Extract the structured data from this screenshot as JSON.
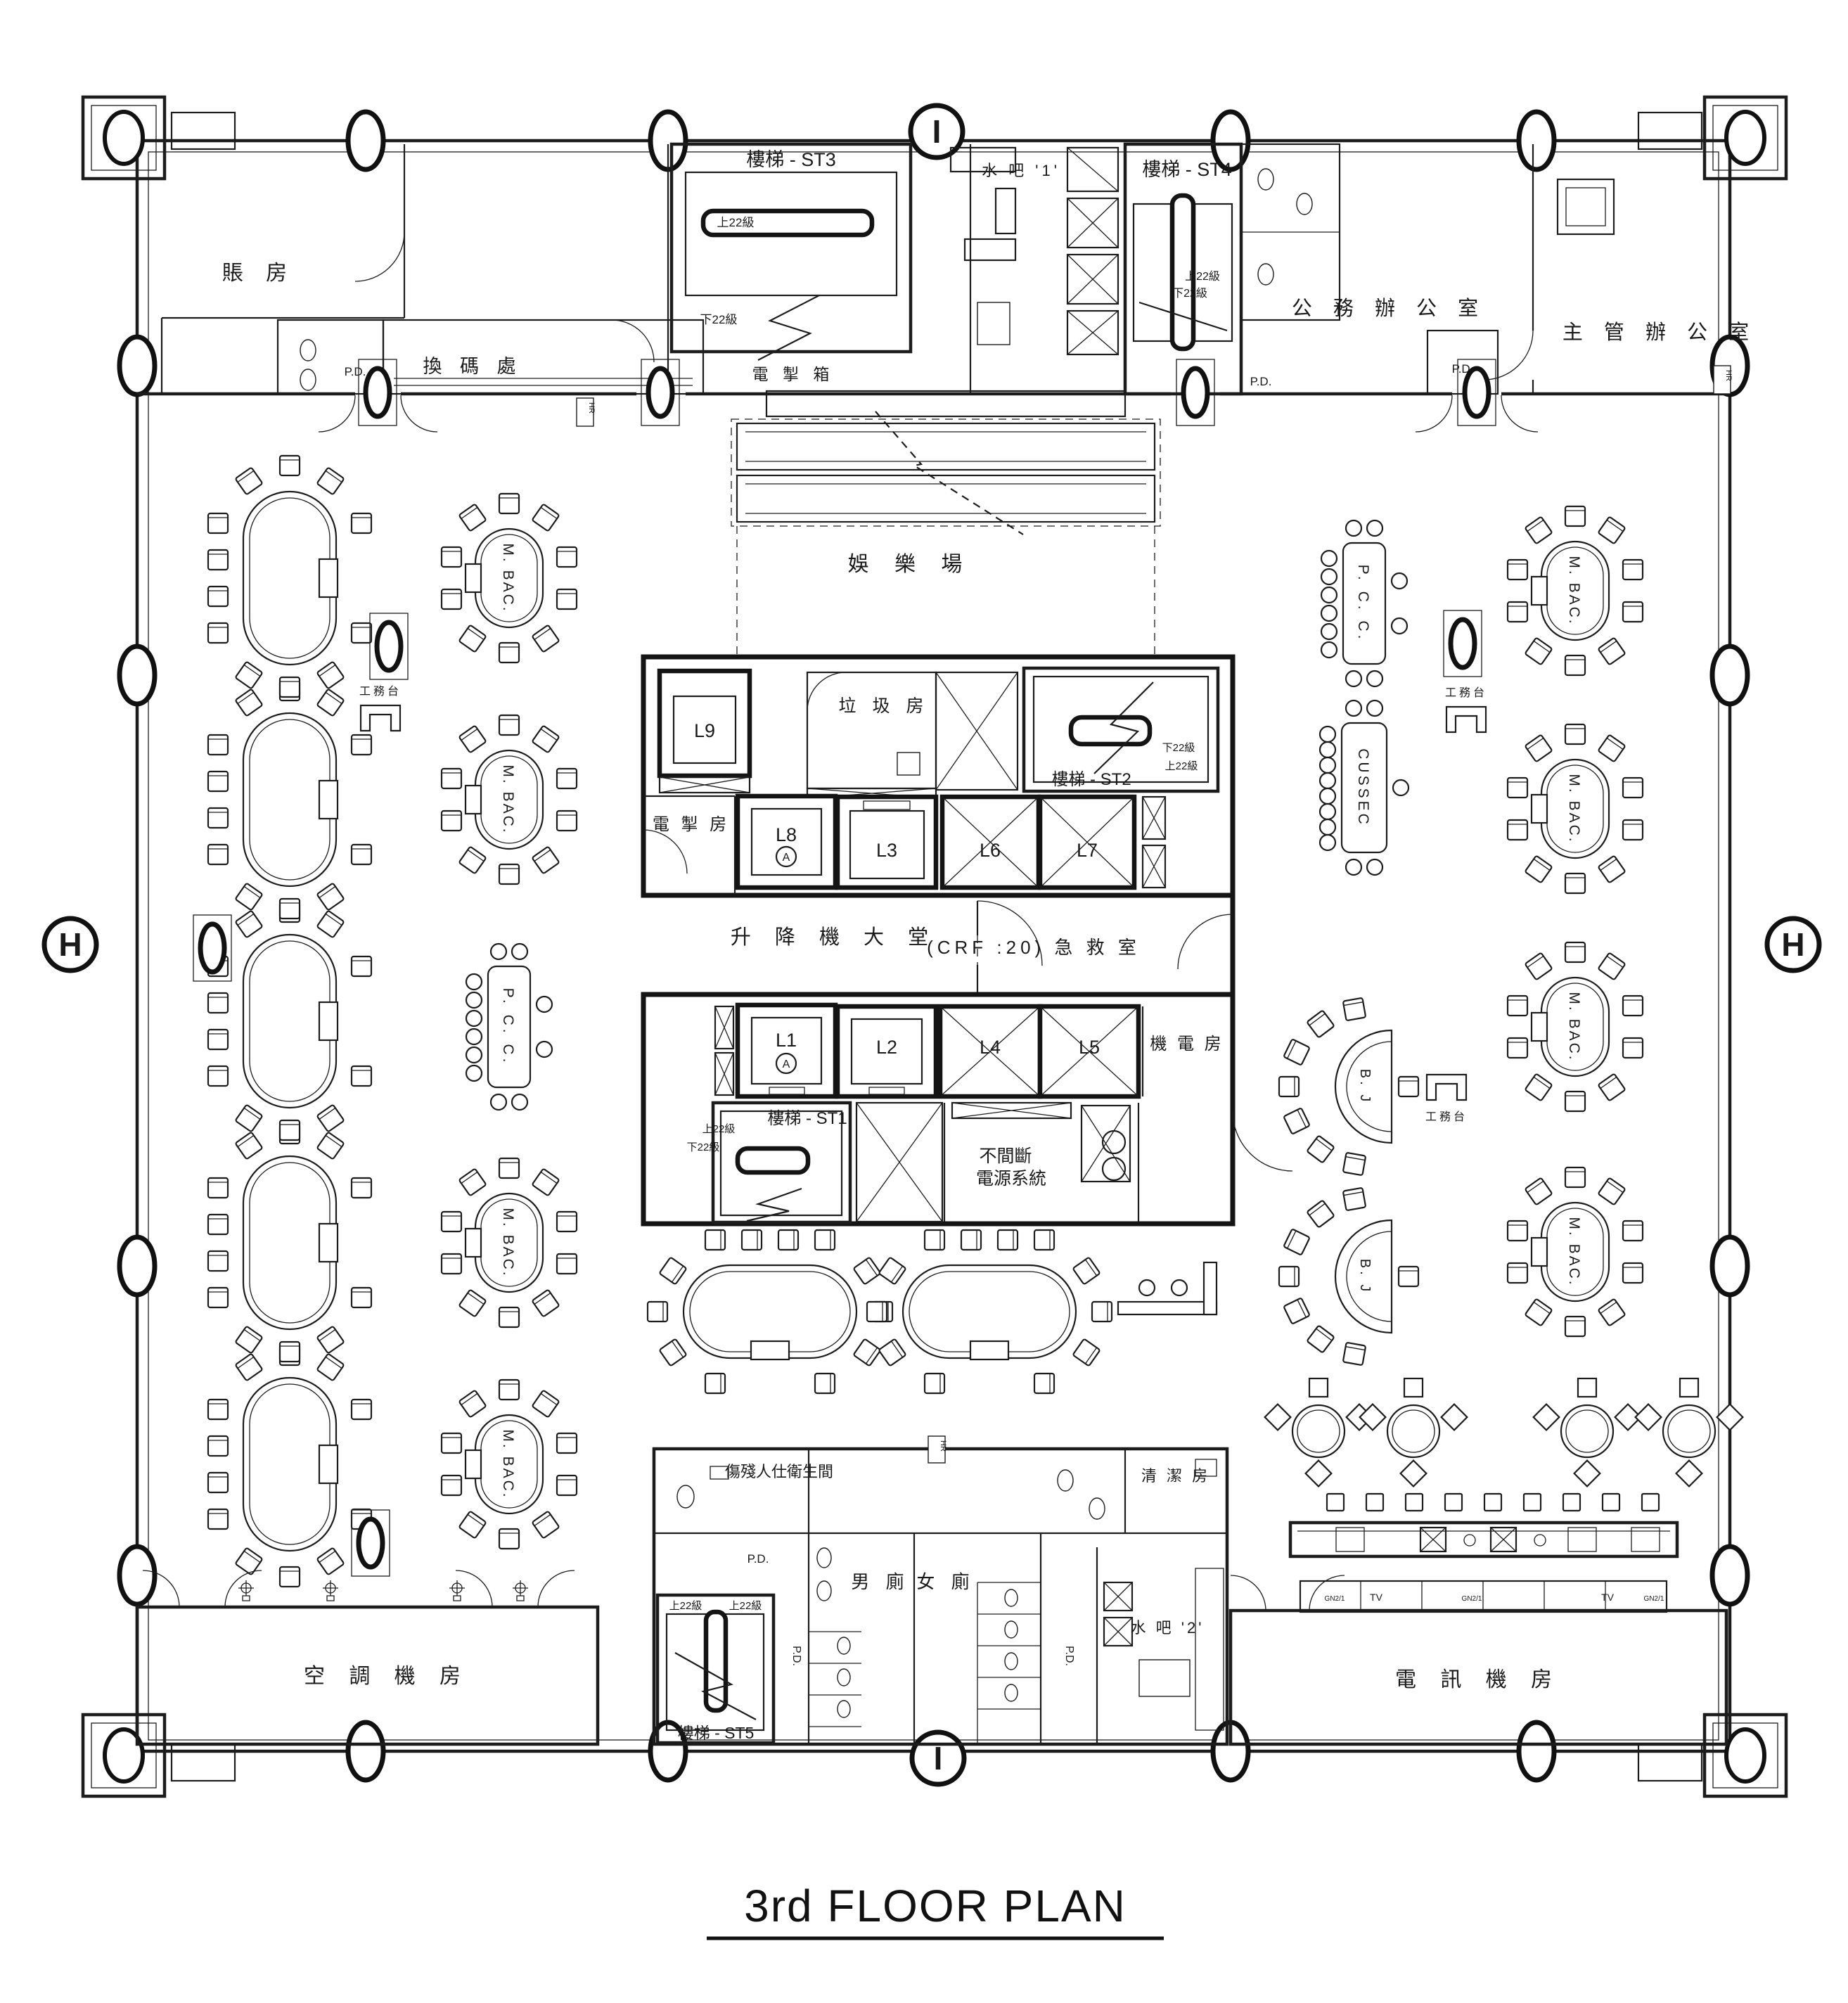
{
  "title": {
    "text": "3rd FLOOR PLAN"
  },
  "grid": {
    "top": "I",
    "bottom": "I",
    "left": "H",
    "right": "H"
  },
  "rooms": {
    "cashier": "賬 房",
    "chip_exchange": "換 碼 處",
    "casino_floor": "娛 樂 場",
    "public_office": "公 務 辦 公 室",
    "manager_office": "主 管 辦 公 室",
    "water_bar_1": "水 吧 '1'",
    "water_bar_2": "水 吧 '2'",
    "switch_box": "電 掣 箱",
    "garbage_room": "垃 圾 房",
    "switch_room": "電 掣 房",
    "lift_lobby": "升 降 機 大 堂",
    "first_aid": "(CRF :20)   急 救 室",
    "ups_line1": "不間斷",
    "ups_line2": "電源系統",
    "me_room": "機 電 房",
    "ac_plant": "空 調 機 房",
    "telecom_room": "電 訊 機 房",
    "mens_toilet": "男 廁",
    "womens_toilet": "女 廁",
    "disabled_toilet": "傷殘人仕衛生間",
    "cleaning_room": "清 潔 房"
  },
  "stairs": {
    "st1": "樓梯 - ST1",
    "st2": "樓梯 - ST2",
    "st3": "樓梯 - ST3",
    "st4": "樓梯 - ST4",
    "st5": "樓梯 - ST5",
    "up_22": "上22級",
    "down_22": "下22級"
  },
  "lifts": {
    "l1": "L1",
    "l2": "L2",
    "l3": "L3",
    "l4": "L4",
    "l5": "L5",
    "l6": "L6",
    "l7": "L7",
    "l8": "L8",
    "l9": "L9",
    "alarm": "A"
  },
  "tables": {
    "m_bac": "M. BAC.",
    "pcc": "P. C. C.",
    "cussec": "CUSSEC",
    "bj": "B. J",
    "service_desk": "工務台"
  },
  "misc": {
    "pd": "P.D.",
    "hr": "HR",
    "tv": "TV",
    "gn": "GN2/1"
  }
}
